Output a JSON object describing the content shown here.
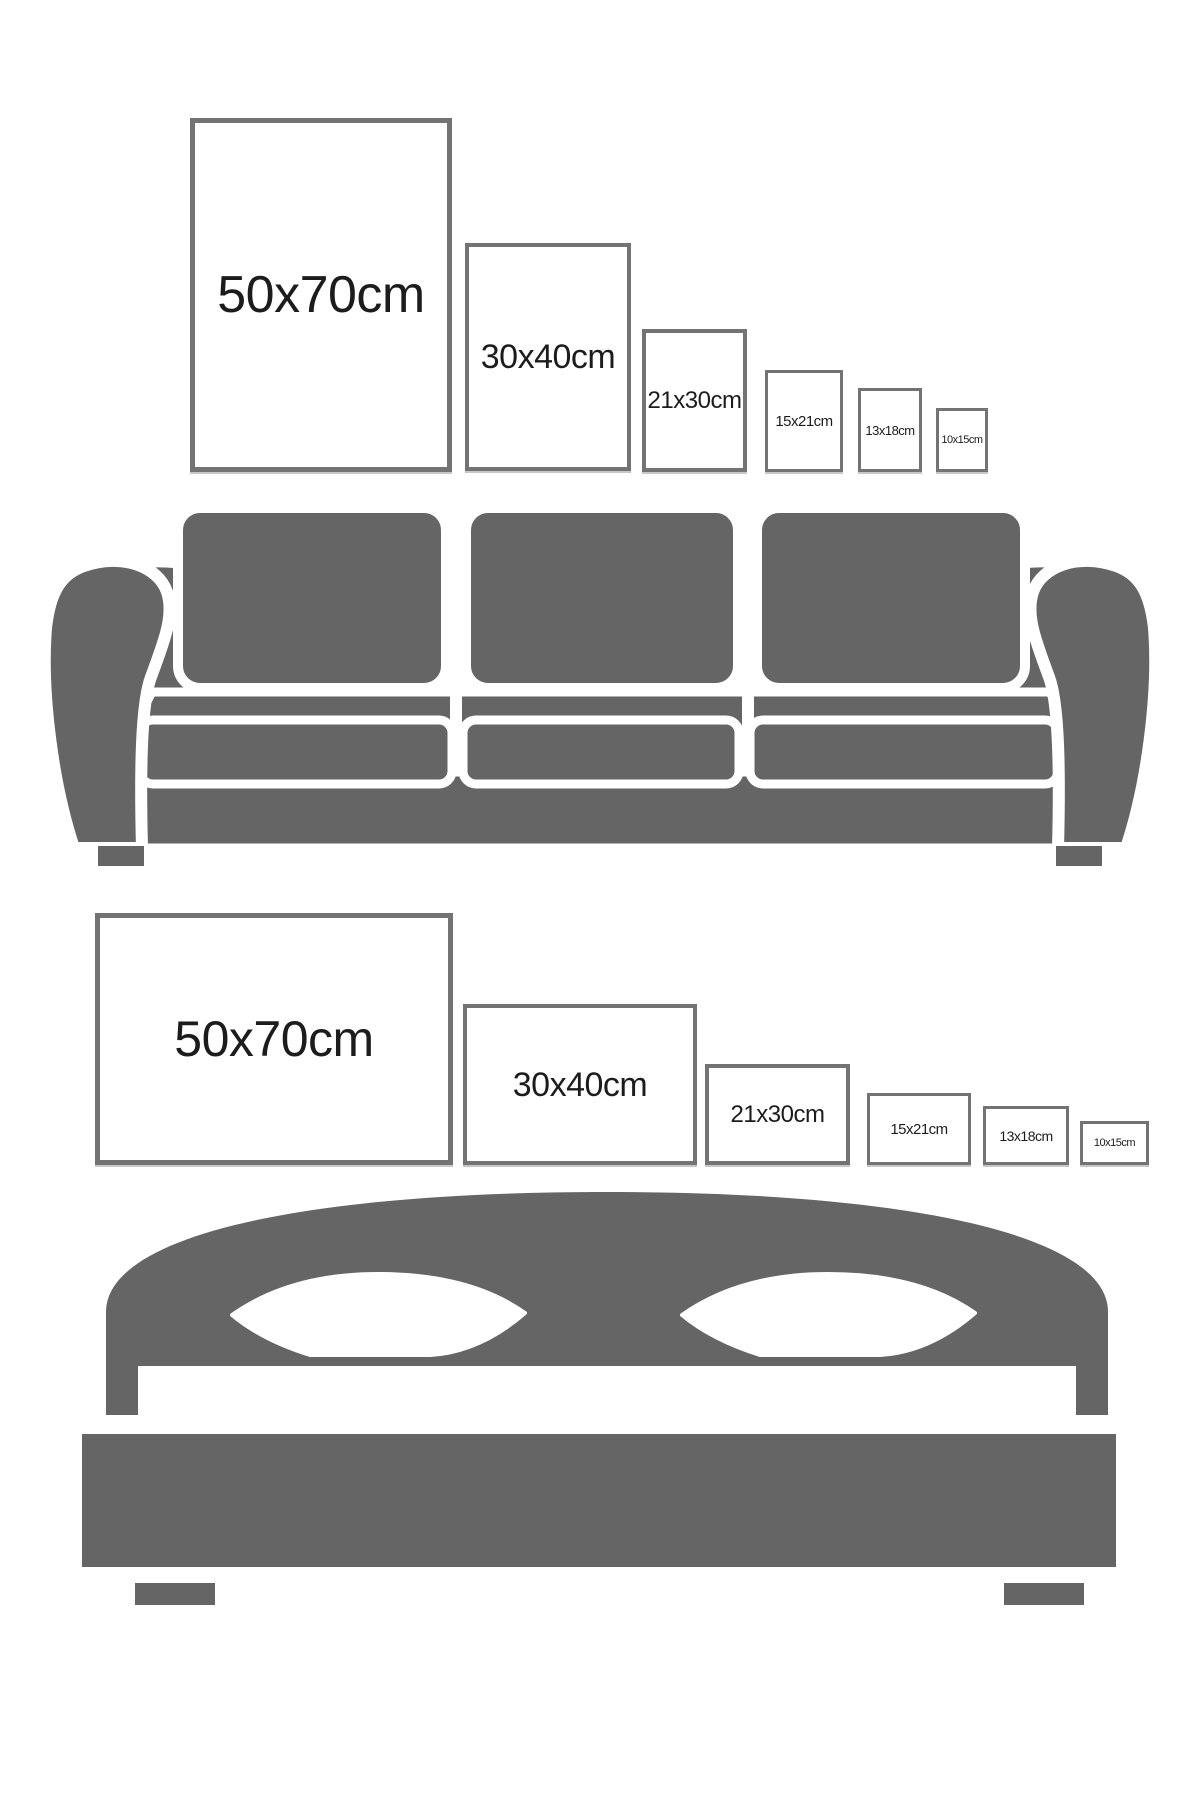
{
  "title": "Poster size comparison guide",
  "colors": {
    "background": "#ffffff",
    "furniture_gray": "#666566",
    "frame_border": "#737373",
    "label_color": "#1c1c1c"
  },
  "chart_data": {
    "type": "table",
    "title": "Frame size comparison over furniture",
    "sizes_cm": [
      "50x70",
      "30x40",
      "21x30",
      "15x21",
      "13x18",
      "10x15"
    ],
    "note": "Same six sizes shown twice: portrait orientation above a sofa, landscape orientation above a bed"
  },
  "sections": [
    {
      "name": "portrait-sizes-over-sofa",
      "furniture": "sofa",
      "orientation": "portrait",
      "frames": [
        {
          "label": "50x70cm",
          "x": 190,
          "y": 118,
          "w": 262,
          "h": 354,
          "font": 52,
          "border": 5
        },
        {
          "label": "30x40cm",
          "x": 465,
          "y": 243,
          "w": 166,
          "h": 228,
          "font": 34,
          "border": 4
        },
        {
          "label": "21x30cm",
          "x": 642,
          "y": 329,
          "w": 105,
          "h": 143,
          "font": 24,
          "border": 4
        },
        {
          "label": "15x21cm",
          "x": 765,
          "y": 370,
          "w": 78,
          "h": 102,
          "font": 15,
          "border": 3
        },
        {
          "label": "13x18cm",
          "x": 858,
          "y": 388,
          "w": 64,
          "h": 84,
          "font": 13,
          "border": 3
        },
        {
          "label": "10x15cm",
          "x": 936,
          "y": 408,
          "w": 52,
          "h": 64,
          "font": 11,
          "border": 3
        }
      ]
    },
    {
      "name": "landscape-sizes-over-bed",
      "furniture": "bed",
      "orientation": "landscape",
      "frames": [
        {
          "label": "50x70cm",
          "x": 95,
          "y": 913,
          "w": 358,
          "h": 252,
          "font": 50,
          "border": 5
        },
        {
          "label": "30x40cm",
          "x": 463,
          "y": 1004,
          "w": 234,
          "h": 161,
          "font": 34,
          "border": 4
        },
        {
          "label": "21x30cm",
          "x": 705,
          "y": 1064,
          "w": 145,
          "h": 101,
          "font": 24,
          "border": 4
        },
        {
          "label": "15x21cm",
          "x": 867,
          "y": 1093,
          "w": 104,
          "h": 72,
          "font": 15,
          "border": 3
        },
        {
          "label": "13x18cm",
          "x": 983,
          "y": 1106,
          "w": 86,
          "h": 59,
          "font": 14,
          "border": 3
        },
        {
          "label": "10x15cm",
          "x": 1080,
          "y": 1121,
          "w": 69,
          "h": 44,
          "font": 11,
          "border": 3
        }
      ]
    }
  ]
}
